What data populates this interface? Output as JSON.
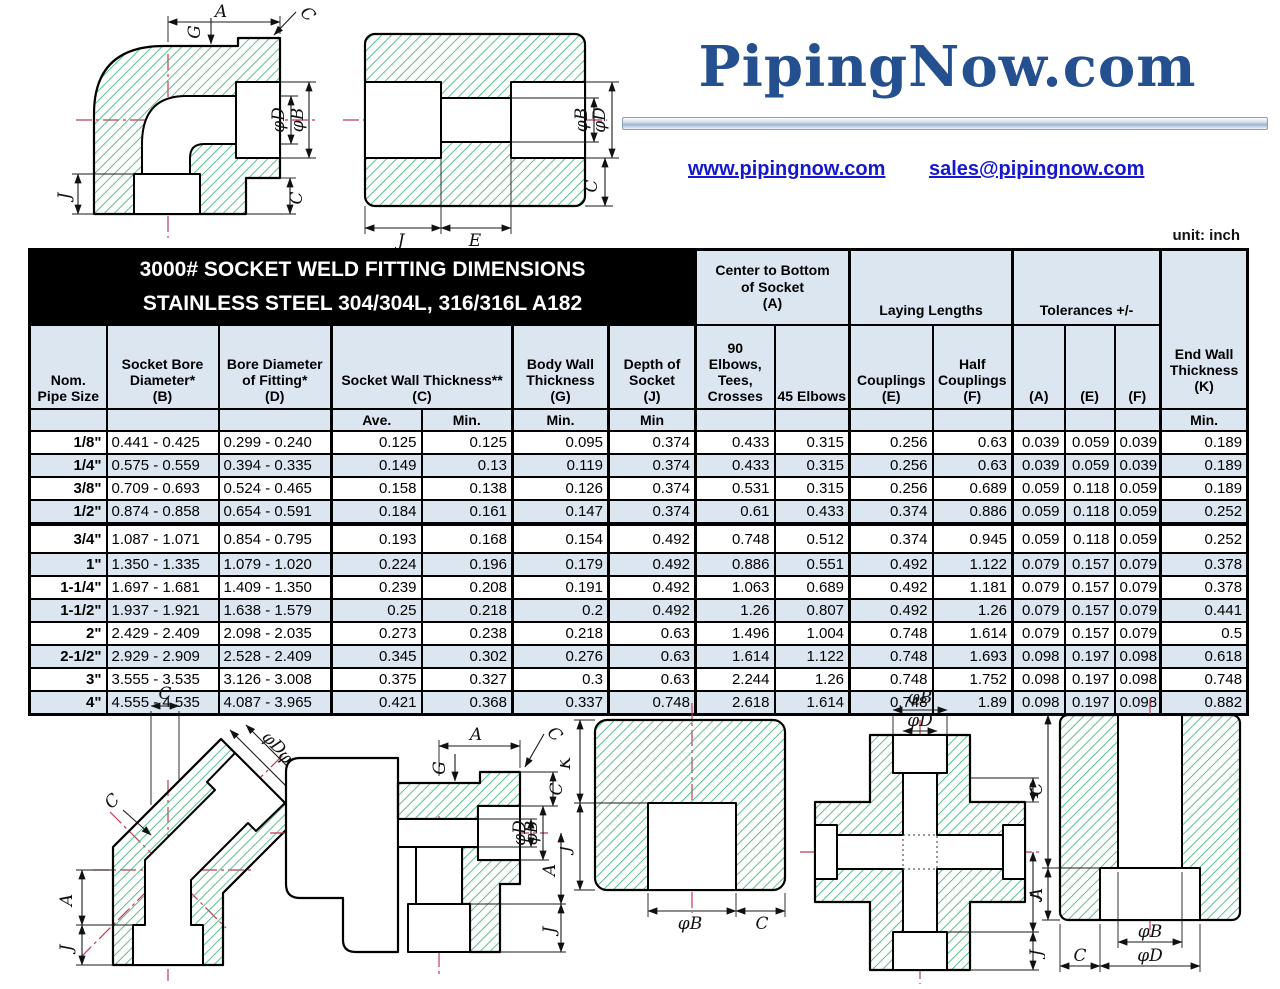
{
  "header": {
    "logo_text": "PipingNow.com",
    "website": "www.pipingnow.com",
    "email": "sales@pipingnow.com"
  },
  "page": {
    "unit_label": "unit: inch"
  },
  "colors": {
    "accent_navy": "#24508f",
    "link_blue": "#1518cf",
    "hatch_green": "#33b06f",
    "centerline_red": "#c23b54",
    "header_bg": "#dce6f1",
    "table_border": "#000000"
  },
  "dims": {
    "A": "A",
    "C": "C",
    "E": "E",
    "F": "F",
    "G": "G",
    "J": "J",
    "K": "K",
    "phiB": "φB",
    "phiD": "φD"
  },
  "table": {
    "title": "3000# SOCKET WELD FITTING DIMENSIONS\nSTAINLESS STEEL 304/304L, 316/316L  A182",
    "group_headers": {
      "center_bottom": "Center to Bottom\nof Socket\n(A)",
      "laying": "Laying Lengths",
      "tolerances": "Tolerances +/-"
    },
    "col_headers": {
      "nom": "Nom.\nPipe Size",
      "socket_bore": "Socket Bore\nDiameter*\n(B)",
      "bore_fitting": "Bore Diameter\nof Fitting*\n(D)",
      "socket_wall": "Socket Wall Thickness**\n(C)",
      "body_wall": "Body Wall\nThickness\n(G)",
      "depth_socket": "Depth of\nSocket\n(J)",
      "elbows90": "90\nElbows,\nTees,\nCrosses",
      "elbows45": "45 Elbows",
      "couplings": "Couplings\n(E)",
      "half_couplings": "Half\nCouplings\n(F)",
      "tol_a": "(A)",
      "tol_e": "(E)",
      "tol_f": "(F)",
      "end_wall": "End Wall\nThickness\n(K)"
    },
    "subheaders": [
      "",
      "",
      "",
      "Ave.",
      "Min.",
      "Min.",
      "Min",
      "",
      "",
      "",
      "",
      "",
      "",
      "",
      "Min."
    ],
    "rows": [
      [
        "1/8\"",
        "0.441 - 0.425",
        "0.299 - 0.240",
        "0.125",
        "0.125",
        "0.095",
        "0.374",
        "0.433",
        "0.315",
        "0.256",
        "0.63",
        "0.039",
        "0.059",
        "0.039",
        "0.189"
      ],
      [
        "1/4\"",
        "0.575 - 0.559",
        "0.394 - 0.335",
        "0.149",
        "0.13",
        "0.119",
        "0.374",
        "0.433",
        "0.315",
        "0.256",
        "0.63",
        "0.039",
        "0.059",
        "0.039",
        "0.189"
      ],
      [
        "3/8\"",
        "0.709 - 0.693",
        "0.524 - 0.465",
        "0.158",
        "0.138",
        "0.126",
        "0.374",
        "0.531",
        "0.315",
        "0.256",
        "0.689",
        "0.059",
        "0.118",
        "0.059",
        "0.189"
      ],
      [
        "1/2\"",
        "0.874 - 0.858",
        "0.654 - 0.591",
        "0.184",
        "0.161",
        "0.147",
        "0.374",
        "0.61",
        "0.433",
        "0.374",
        "0.886",
        "0.059",
        "0.118",
        "0.059",
        "0.252"
      ],
      [
        "3/4\"",
        "1.087 - 1.071",
        "0.854 - 0.795",
        "0.193",
        "0.168",
        "0.154",
        "0.492",
        "0.748",
        "0.512",
        "0.374",
        "0.945",
        "0.059",
        "0.118",
        "0.059",
        "0.252"
      ],
      [
        "1\"",
        "1.350 - 1.335",
        "1.079 - 1.020",
        "0.224",
        "0.196",
        "0.179",
        "0.492",
        "0.886",
        "0.551",
        "0.492",
        "1.122",
        "0.079",
        "0.157",
        "0.079",
        "0.378"
      ],
      [
        "1-1/4\"",
        "1.697 - 1.681",
        "1.409 - 1.350",
        "0.239",
        "0.208",
        "0.191",
        "0.492",
        "1.063",
        "0.689",
        "0.492",
        "1.181",
        "0.079",
        "0.157",
        "0.079",
        "0.378"
      ],
      [
        "1-1/2\"",
        "1.937 - 1.921",
        "1.638 - 1.579",
        "0.25",
        "0.218",
        "0.2",
        "0.492",
        "1.26",
        "0.807",
        "0.492",
        "1.26",
        "0.079",
        "0.157",
        "0.079",
        "0.441"
      ],
      [
        "2\"",
        "2.429 - 2.409",
        "2.098 - 2.035",
        "0.273",
        "0.238",
        "0.218",
        "0.63",
        "1.496",
        "1.004",
        "0.748",
        "1.614",
        "0.079",
        "0.157",
        "0.079",
        "0.5"
      ],
      [
        "2-1/2\"",
        "2.929 - 2.909",
        "2.528 - 2.409",
        "0.345",
        "0.302",
        "0.276",
        "0.63",
        "1.614",
        "1.122",
        "0.748",
        "1.693",
        "0.098",
        "0.197",
        "0.098",
        "0.618"
      ],
      [
        "3\"",
        "3.555 - 3.535",
        "3.126 - 3.008",
        "0.375",
        "0.327",
        "0.3",
        "0.63",
        "2.244",
        "1.26",
        "0.748",
        "1.752",
        "0.098",
        "0.197",
        "0.098",
        "0.748"
      ],
      [
        "4\"",
        "4.555 - 4.535",
        "4.087 - 3.965",
        "0.421",
        "0.368",
        "0.337",
        "0.748",
        "2.618",
        "1.614",
        "0.748",
        "1.89",
        "0.098",
        "0.197",
        "0.098",
        "0.882"
      ]
    ]
  }
}
